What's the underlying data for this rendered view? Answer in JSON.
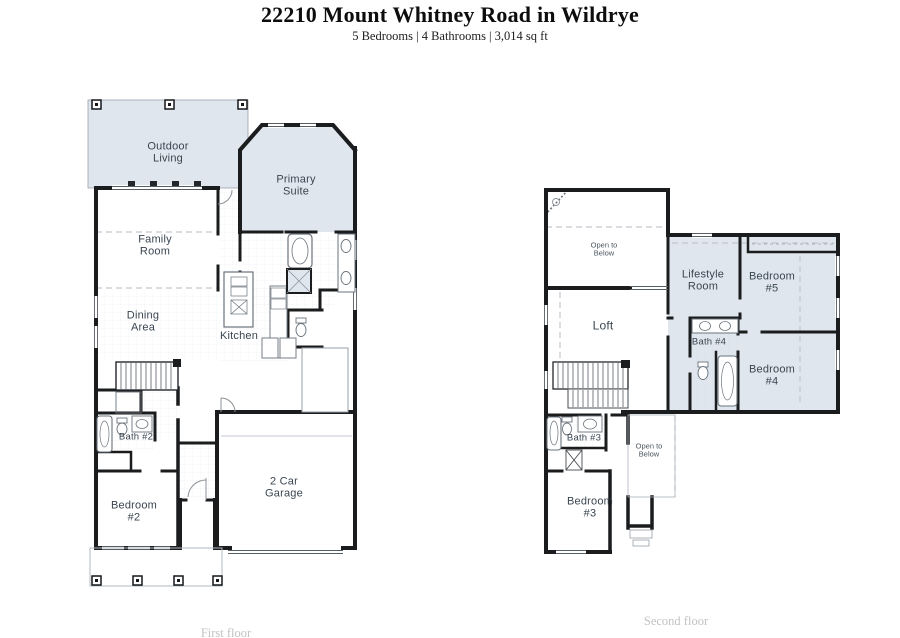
{
  "header": {
    "title": "22210 Mount Whitney Road in Wildrye",
    "subtitle": "5 Bedrooms | 4 Bathrooms | 3,014 sq ft"
  },
  "floor1": {
    "caption": "First floor",
    "labels": {
      "outdoor_living": {
        "l1": "Outdoor",
        "l2": "Living"
      },
      "primary_suite": {
        "l1": "Primary",
        "l2": "Suite"
      },
      "family_room": {
        "l1": "Family",
        "l2": "Room"
      },
      "dining_area": {
        "l1": "Dining",
        "l2": "Area"
      },
      "kitchen": {
        "l1": "Kitchen",
        "l2": ""
      },
      "bath_2": {
        "l1": "Bath #2",
        "l2": ""
      },
      "bedroom_2": {
        "l1": "Bedroom",
        "l2": "#2"
      },
      "garage": {
        "l1": "2 Car",
        "l2": "Garage"
      }
    }
  },
  "floor2": {
    "caption": "Second floor",
    "labels": {
      "open_to_below_top": {
        "l1": "Open to",
        "l2": "Below"
      },
      "lifestyle_room": {
        "l1": "Lifestyle",
        "l2": "Room"
      },
      "bedroom_5": {
        "l1": "Bedroom",
        "l2": "#5"
      },
      "loft": {
        "l1": "Loft",
        "l2": ""
      },
      "bath_4": {
        "l1": "Bath #4",
        "l2": ""
      },
      "bedroom_4": {
        "l1": "Bedroom",
        "l2": "#4"
      },
      "bath_3": {
        "l1": "Bath #3",
        "l2": ""
      },
      "open_to_below_center": {
        "l1": "Open to",
        "l2": "Below"
      },
      "bedroom_3": {
        "l1": "Bedroom",
        "l2": "#3"
      }
    }
  },
  "colors": {
    "room_shade": "#dfe6ee",
    "wall": "#1a1c1e",
    "label_text": "#3a4550",
    "caption_text": "#c2c2c2"
  }
}
